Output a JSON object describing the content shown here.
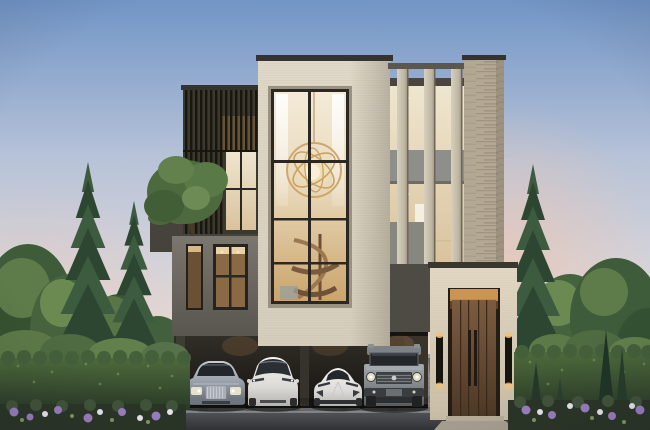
{
  "palette": {
    "sky_top": "#7195c6",
    "sky_mid": "#b9c4d8",
    "sky_horizon": "#eedacd",
    "sunset_pink": "#eec4ae",
    "conifer_dark": "#2c4631",
    "conifer_mid": "#3d5b3f",
    "foliage_dark": "#3f5c3a",
    "foliage_light": "#6a8a52",
    "hedge_light": "#4e6a3c",
    "hedge_dark": "#293a26",
    "stone_light": "#d6cebd",
    "stone_textured": "#b3a894",
    "stone_entrance": "#c9bda6",
    "cap_dark": "#35332f",
    "louvre_dark": "#3b382e",
    "grey_wall": "#59554f",
    "carport_shadow": "#16140f",
    "glass_warm": "#e9d9ba",
    "glass_amber": "#c9a36a",
    "mullion": "#2b2823",
    "door_wood": "#4e3826",
    "stair_wood": "#8a6446",
    "chandelier_gold": "#c9a264",
    "curtain_white": "#f6f2ea",
    "pavement": "#7d7f83",
    "pavement_band": "#5f6164",
    "road": "#303236",
    "car_silver": "#9aa2ab",
    "car_white": "#f4f3f0",
    "car_grey": "#81878b",
    "flower_purple": "#9a7fc0",
    "flower_white": "#eae7ef",
    "sconce_glow": "#f0c27a"
  },
  "scene": {
    "type": "exterior-architectural-rendering",
    "time_of_day": "dusk",
    "building": {
      "style": "modern-contemporary-house",
      "storeys": 3,
      "features": [
        "dark-vertical-louvre-box",
        "roof-terrace-with-tree",
        "double-height-glass-window",
        "gold-orb-chandelier",
        "spiral-staircase",
        "stone-fin-windows",
        "travertine-pier",
        "tall-wood-entrance-door",
        "black-wall-sconces",
        "open-carport"
      ]
    },
    "vehicles": [
      {
        "position": 1,
        "type": "luxury-sedan",
        "color_name": "silver"
      },
      {
        "position": 2,
        "type": "electric-crossover",
        "color_name": "white"
      },
      {
        "position": 3,
        "type": "sports-car",
        "color_name": "white"
      },
      {
        "position": 4,
        "type": "offroad-suv",
        "color_name": "grey"
      }
    ],
    "landscaping": [
      "conifer-trees",
      "deciduous-trees",
      "clipped-hedges",
      "cypress-shrubs",
      "flower-beds-purple-white",
      "paved-driveway",
      "asphalt-road"
    ]
  }
}
